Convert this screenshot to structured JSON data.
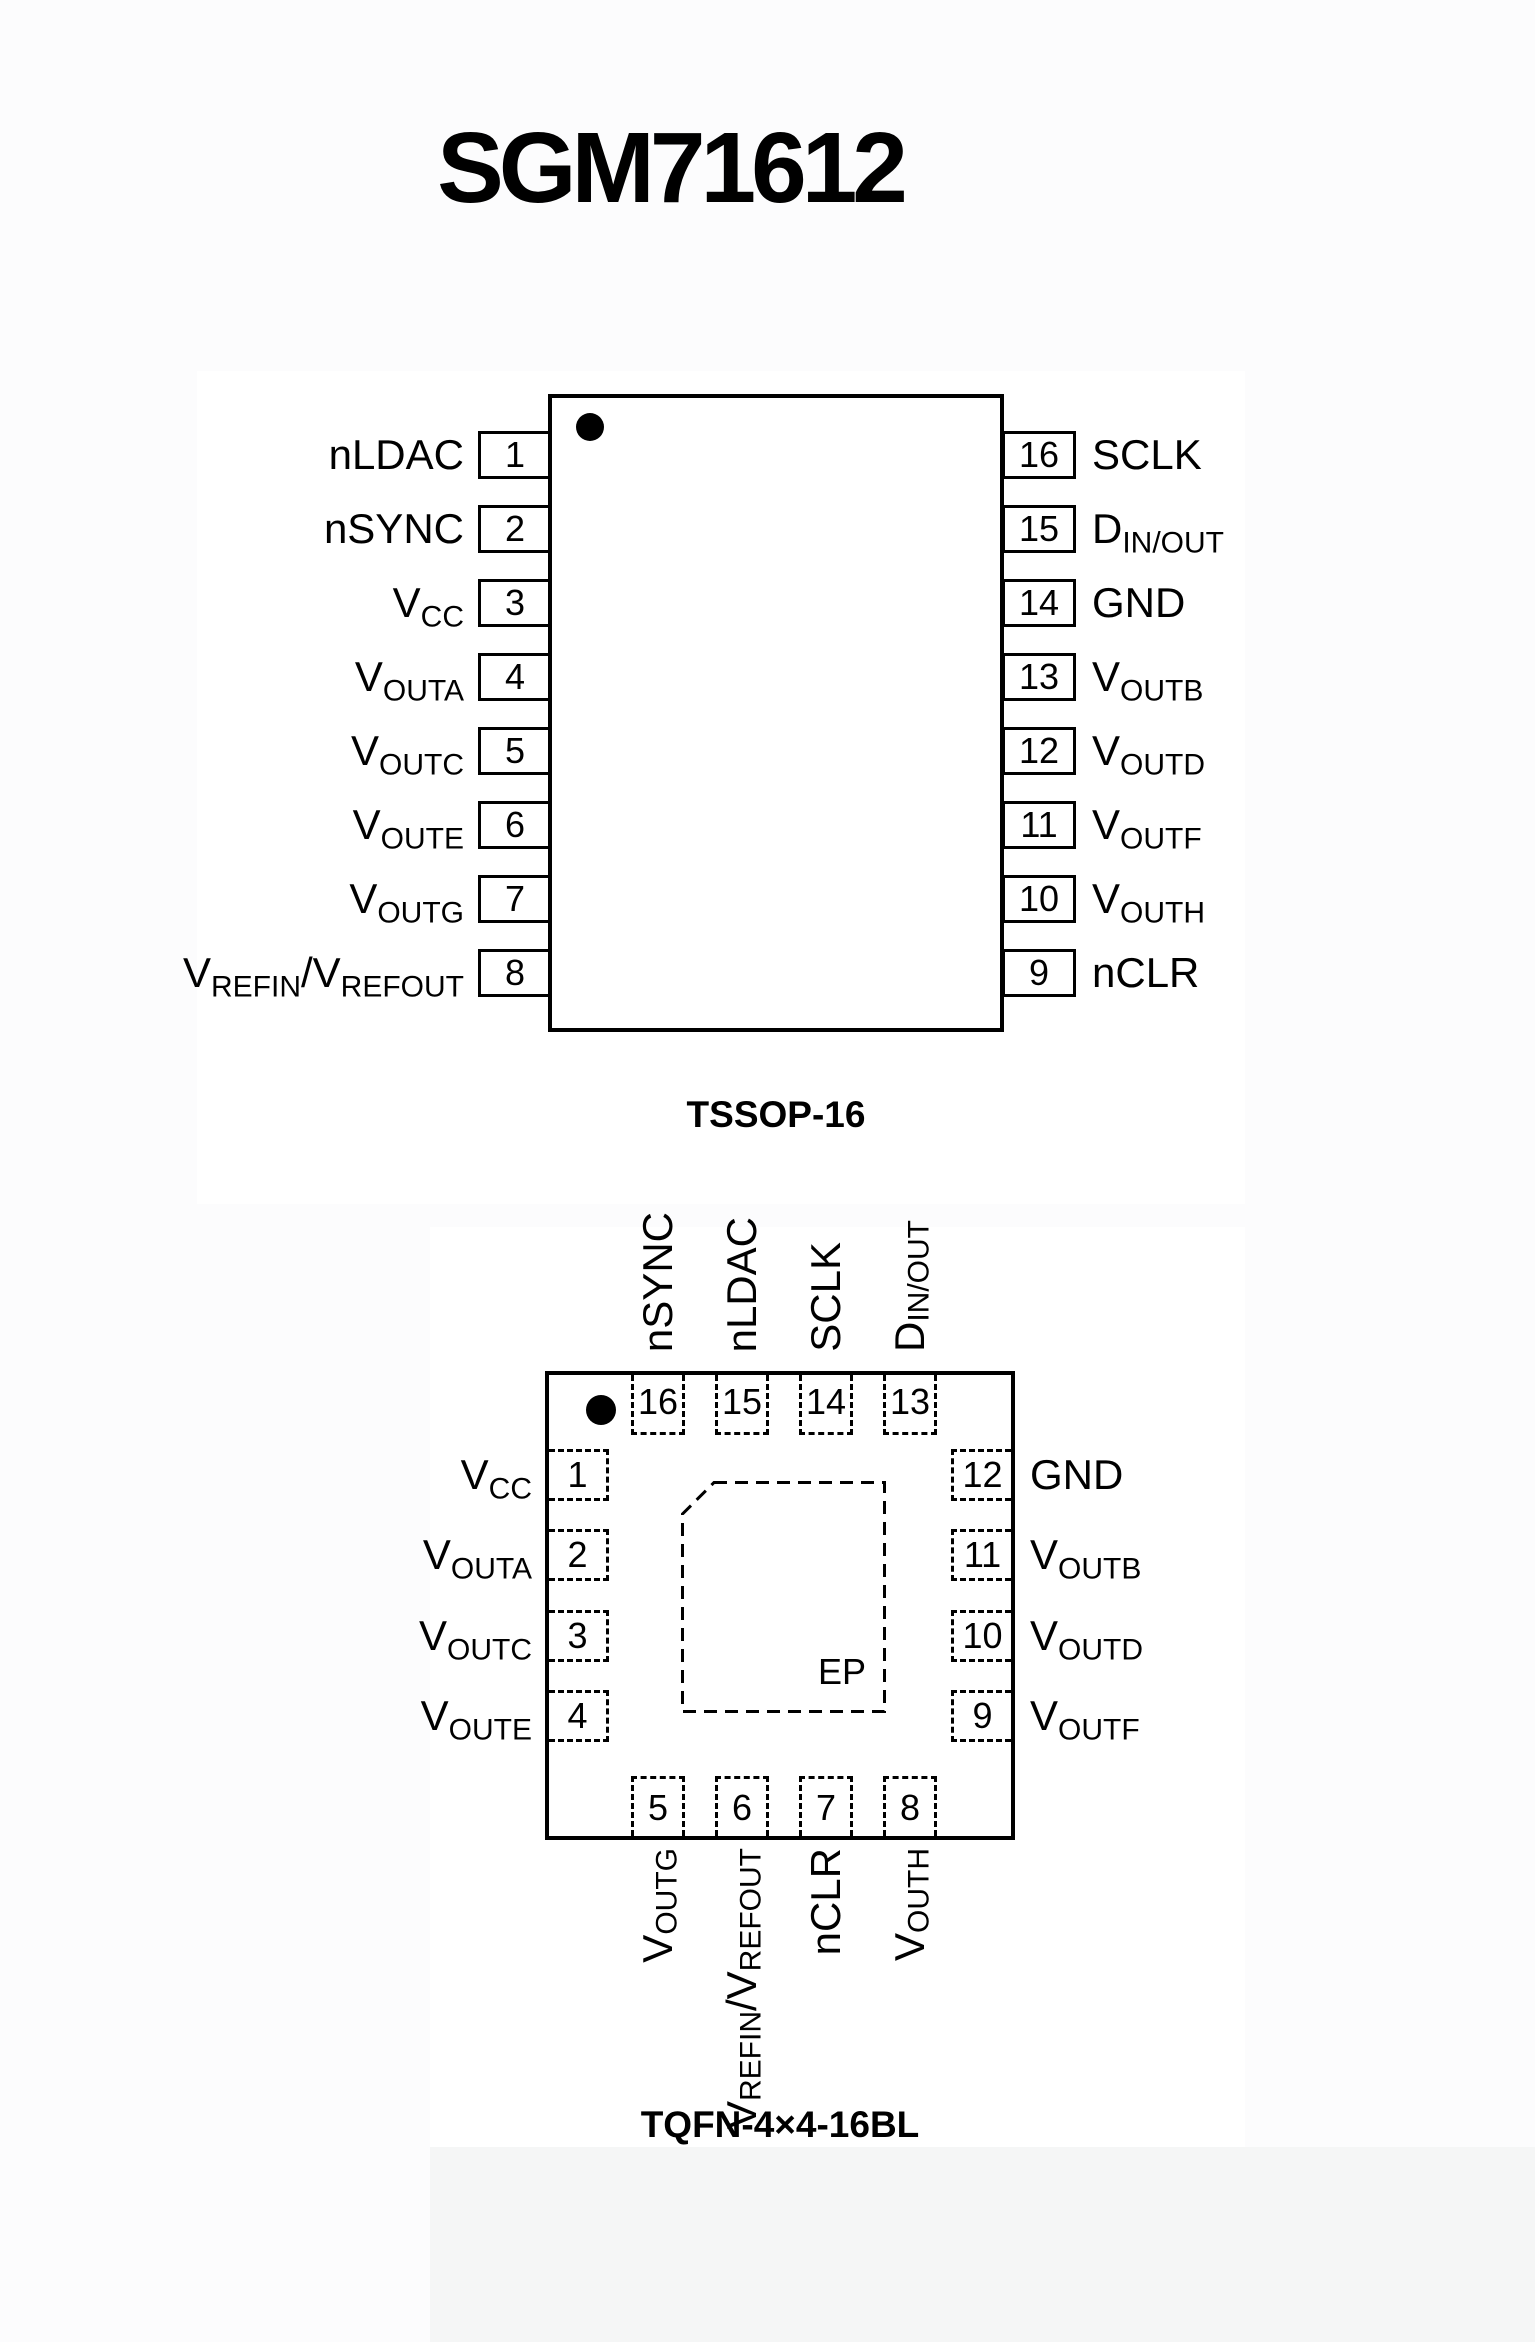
{
  "title": "SGM71612",
  "colors": {
    "ink": "#000000",
    "page_bg": "#fcfcfd",
    "panel_bg": "#ffffff",
    "bottom_strip_bg": "#f5f6f6"
  },
  "tssop": {
    "caption": "TSSOP-16",
    "left_pins": [
      {
        "num": "1",
        "parts": [
          {
            "t": "nLDAC"
          }
        ]
      },
      {
        "num": "2",
        "parts": [
          {
            "t": "nSYNC"
          }
        ]
      },
      {
        "num": "3",
        "parts": [
          {
            "t": "V"
          },
          {
            "s": "CC"
          }
        ]
      },
      {
        "num": "4",
        "parts": [
          {
            "t": "V"
          },
          {
            "s": "OUTA"
          }
        ]
      },
      {
        "num": "5",
        "parts": [
          {
            "t": "V"
          },
          {
            "s": "OUTC"
          }
        ]
      },
      {
        "num": "6",
        "parts": [
          {
            "t": "V"
          },
          {
            "s": "OUTE"
          }
        ]
      },
      {
        "num": "7",
        "parts": [
          {
            "t": "V"
          },
          {
            "s": "OUTG"
          }
        ]
      },
      {
        "num": "8",
        "parts": [
          {
            "t": "V"
          },
          {
            "s": "REFIN"
          },
          {
            "t": "/V"
          },
          {
            "s": "REFOUT"
          }
        ]
      }
    ],
    "right_pins": [
      {
        "num": "16",
        "parts": [
          {
            "t": "SCLK"
          }
        ]
      },
      {
        "num": "15",
        "parts": [
          {
            "t": "D"
          },
          {
            "s": "IN/OUT"
          }
        ]
      },
      {
        "num": "14",
        "parts": [
          {
            "t": "GND"
          }
        ]
      },
      {
        "num": "13",
        "parts": [
          {
            "t": "V"
          },
          {
            "s": "OUTB"
          }
        ]
      },
      {
        "num": "12",
        "parts": [
          {
            "t": "V"
          },
          {
            "s": "OUTD"
          }
        ]
      },
      {
        "num": "11",
        "parts": [
          {
            "t": "V"
          },
          {
            "s": "OUTF"
          }
        ]
      },
      {
        "num": "10",
        "parts": [
          {
            "t": "V"
          },
          {
            "s": "OUTH"
          }
        ]
      },
      {
        "num": "9",
        "parts": [
          {
            "t": "nCLR"
          }
        ]
      }
    ]
  },
  "tqfn": {
    "caption": "TQFN-4×4-16BL",
    "ep_label": "EP",
    "top_pins": [
      {
        "num": "16",
        "parts": [
          {
            "t": "nSYNC"
          }
        ]
      },
      {
        "num": "15",
        "parts": [
          {
            "t": "nLDAC"
          }
        ]
      },
      {
        "num": "14",
        "parts": [
          {
            "t": "SCLK"
          }
        ]
      },
      {
        "num": "13",
        "parts": [
          {
            "t": "D"
          },
          {
            "s": "IN/OUT"
          }
        ]
      }
    ],
    "left_pins": [
      {
        "num": "1",
        "parts": [
          {
            "t": "V"
          },
          {
            "s": "CC"
          }
        ]
      },
      {
        "num": "2",
        "parts": [
          {
            "t": "V"
          },
          {
            "s": "OUTA"
          }
        ]
      },
      {
        "num": "3",
        "parts": [
          {
            "t": "V"
          },
          {
            "s": "OUTC"
          }
        ]
      },
      {
        "num": "4",
        "parts": [
          {
            "t": "V"
          },
          {
            "s": "OUTE"
          }
        ]
      }
    ],
    "right_pins": [
      {
        "num": "12",
        "parts": [
          {
            "t": "GND"
          }
        ]
      },
      {
        "num": "11",
        "parts": [
          {
            "t": "V"
          },
          {
            "s": "OUTB"
          }
        ]
      },
      {
        "num": "10",
        "parts": [
          {
            "t": "V"
          },
          {
            "s": "OUTD"
          }
        ]
      },
      {
        "num": "9",
        "parts": [
          {
            "t": "V"
          },
          {
            "s": "OUTF"
          }
        ]
      }
    ],
    "bottom_pins": [
      {
        "num": "5",
        "parts": [
          {
            "t": "V"
          },
          {
            "s": "OUTG"
          }
        ]
      },
      {
        "num": "6",
        "parts": [
          {
            "t": "V"
          },
          {
            "s": "REFIN"
          },
          {
            "t": "/V"
          },
          {
            "s": "REFOUT"
          }
        ]
      },
      {
        "num": "7",
        "parts": [
          {
            "t": "nCLR"
          }
        ]
      },
      {
        "num": "8",
        "parts": [
          {
            "t": "V"
          },
          {
            "s": "OUTH"
          }
        ]
      }
    ]
  }
}
